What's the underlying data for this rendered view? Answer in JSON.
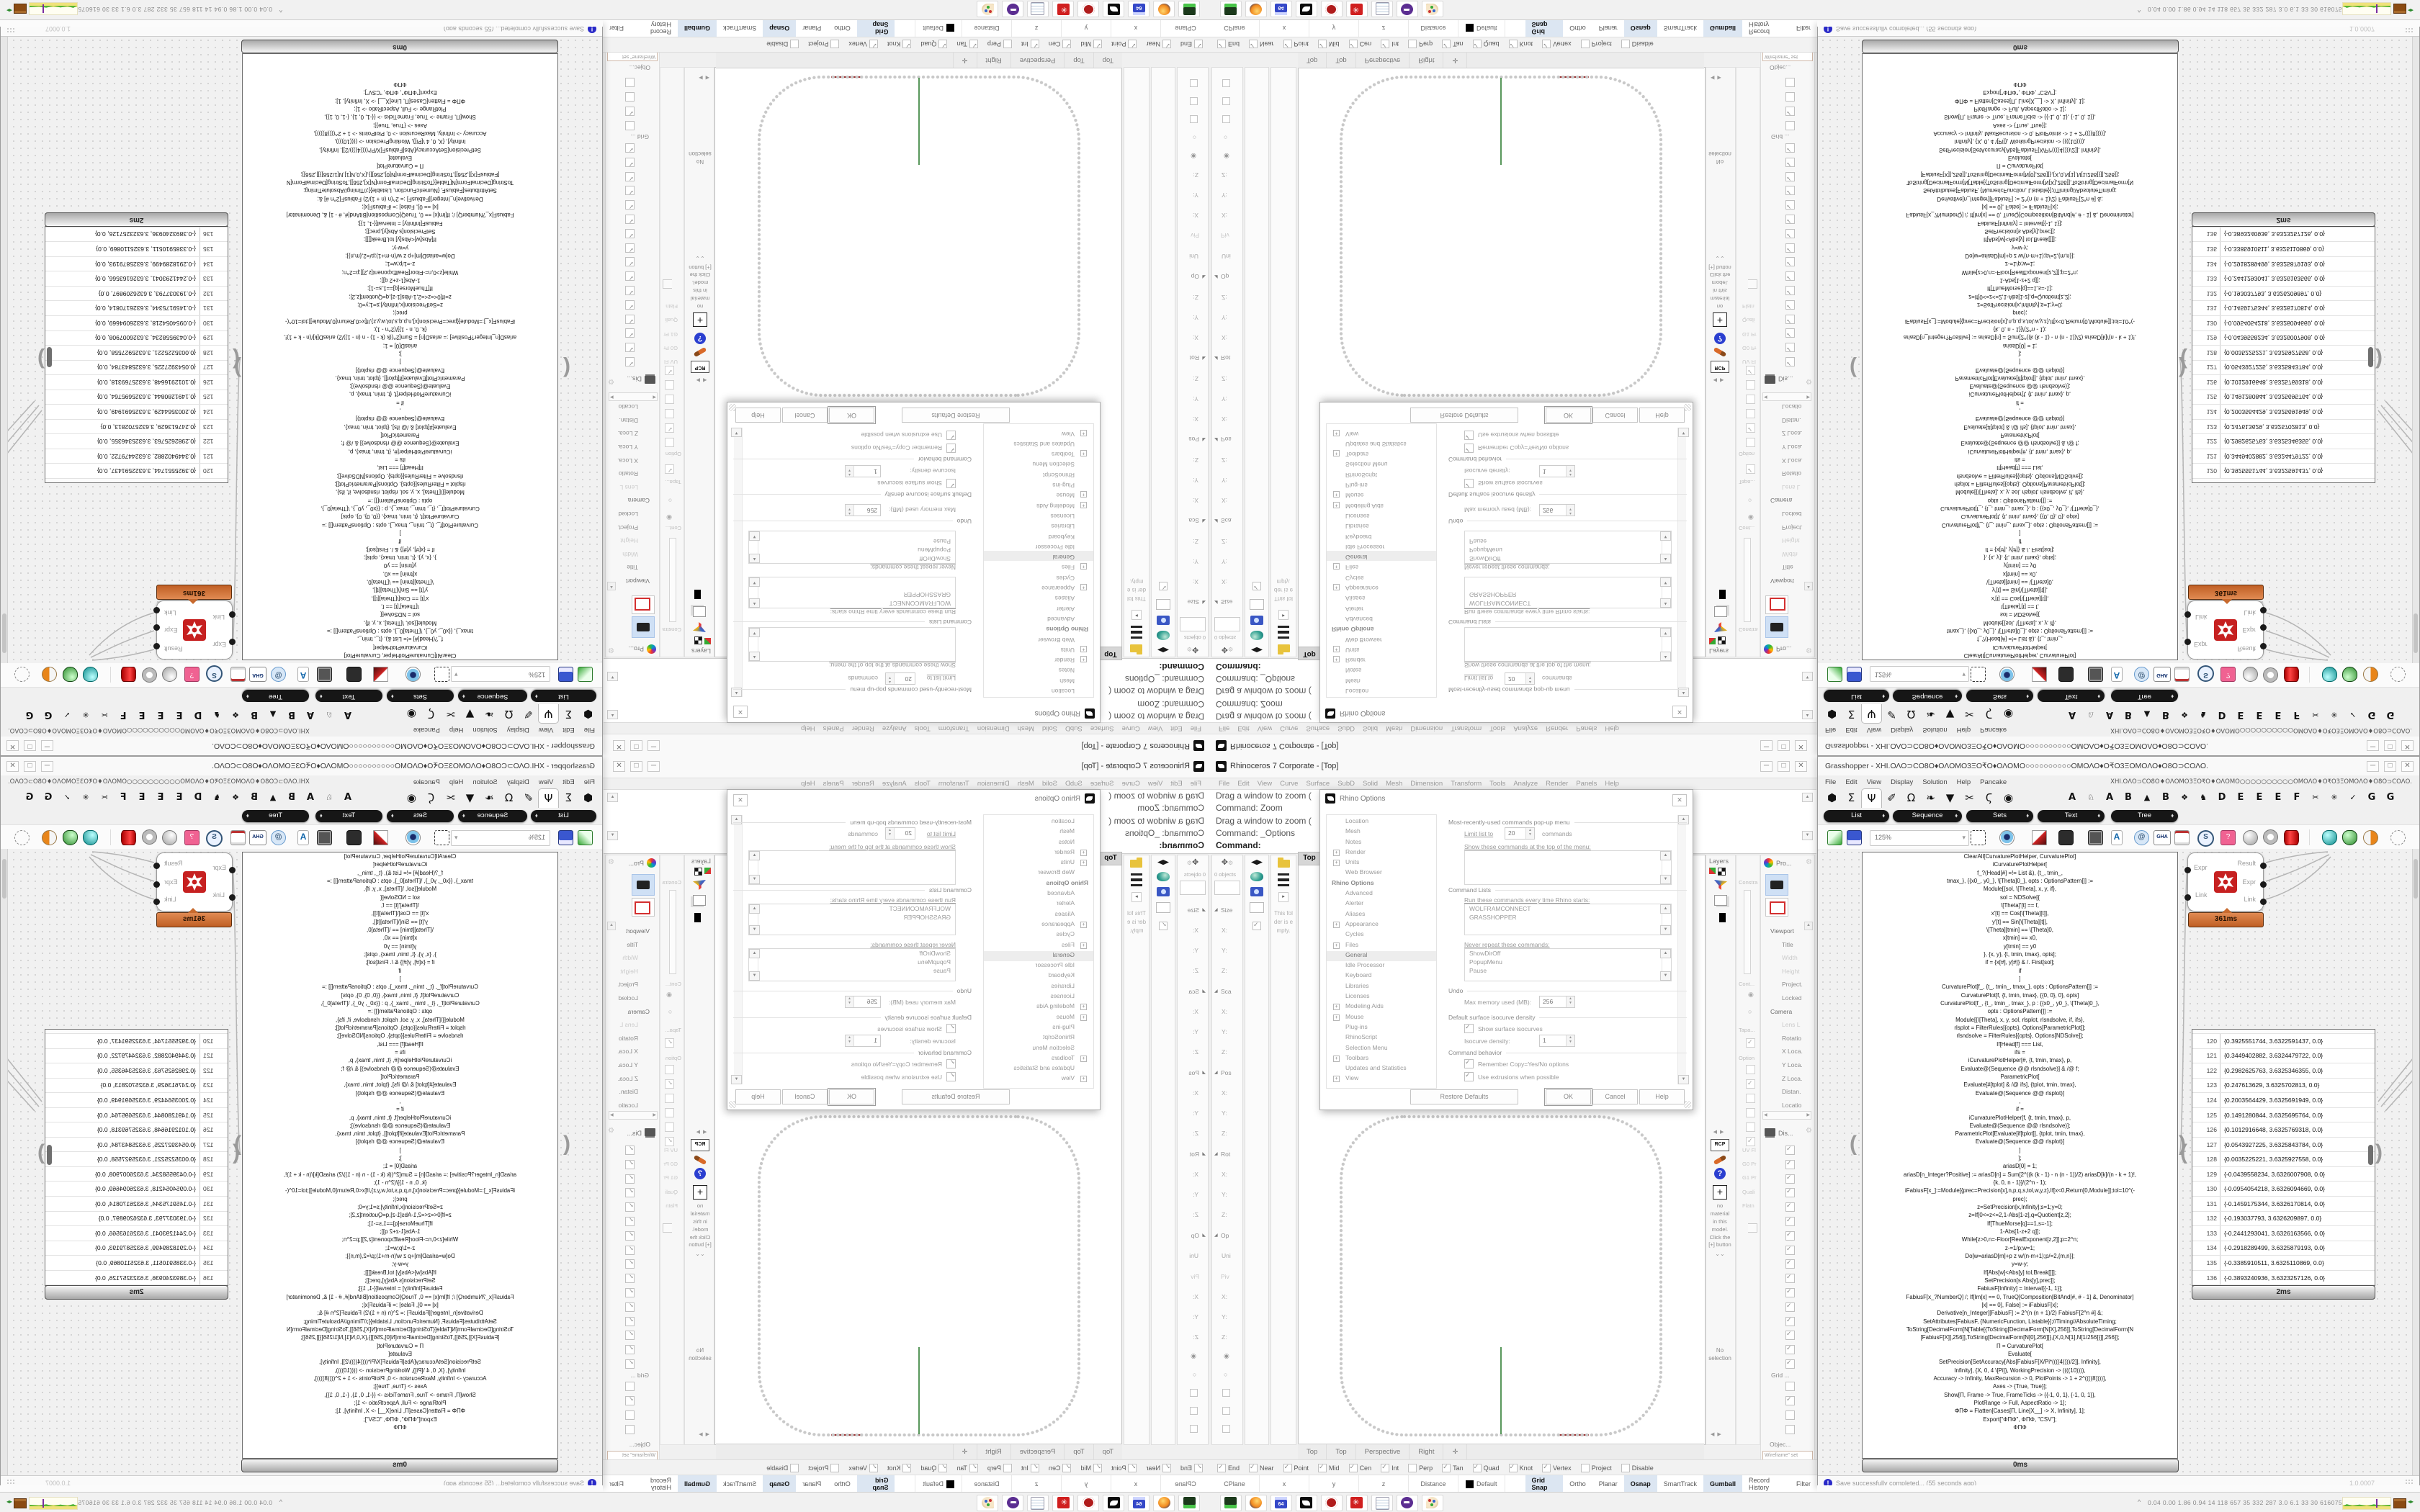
{
  "rhino": {
    "title": "Rhinoceros 7 Corporate - [Top]",
    "window_buttons": {
      "minimize": "─",
      "maximize": "□",
      "close": "✕"
    },
    "menu": [
      "File",
      "Edit",
      "View",
      "Curve",
      "Surface",
      "SubD",
      "Solid",
      "Mesh",
      "Dimension",
      "Transform",
      "Tools",
      "Analyze",
      "Render",
      "Panels",
      "Help"
    ],
    "command_history": [
      "Drag a window to zoom (",
      "Command: Zoom",
      "Drag a window to zoom (",
      "Command: _Options"
    ],
    "command_prompt": "Command:",
    "left_panel": {
      "objects_label": "0 objects",
      "empty_folder_note": "This folder is empty.",
      "boxedit": [
        {
          "c": "h",
          "l": "Size"
        },
        {
          "c": "f",
          "l": "X:"
        },
        {
          "c": "f",
          "l": "Y:"
        },
        {
          "c": "f",
          "l": "Z:"
        },
        {
          "c": "h",
          "l": "Sca"
        },
        {
          "c": "f",
          "l": "X:"
        },
        {
          "c": "f",
          "l": "Y:"
        },
        {
          "c": "f",
          "l": "Z:"
        },
        {
          "c": "h",
          "l": "Pos"
        },
        {
          "c": "f",
          "l": "X:"
        },
        {
          "c": "f",
          "l": "Y:"
        },
        {
          "c": "f",
          "l": "Z:"
        },
        {
          "c": "h",
          "l": "Rot"
        },
        {
          "c": "f",
          "l": "X:"
        },
        {
          "c": "f",
          "l": "Y:"
        },
        {
          "c": "f",
          "l": "Z:"
        },
        {
          "c": "h",
          "l": "Op"
        },
        {
          "c": "f",
          "l": "Uni"
        },
        {
          "c": "hd",
          "l": "Piv"
        },
        {
          "c": "f",
          "l": "X:"
        },
        {
          "c": "f",
          "l": "Y:"
        },
        {
          "c": "f",
          "l": "Z:"
        },
        {
          "c": "ro",
          "l": ""
        },
        {
          "c": "rf",
          "l": ""
        },
        {
          "c": "cb",
          "l": ""
        },
        {
          "c": "cb",
          "l": ""
        },
        {
          "c": "cb",
          "l": ""
        }
      ]
    },
    "viewport": {
      "label": "Top",
      "tabs": [
        "Top",
        "Top",
        "Perspective",
        "Right"
      ],
      "add_tab": "✛"
    },
    "osnap": [
      {
        "l": "End",
        "s": "on"
      },
      {
        "l": "Near",
        "s": "on"
      },
      {
        "l": "Point",
        "s": "on"
      },
      {
        "l": "Mid",
        "s": "on"
      },
      {
        "l": "Cen",
        "s": "on"
      },
      {
        "l": "Int",
        "s": "on"
      },
      {
        "l": "Perp",
        "s": "off"
      },
      {
        "l": "Tan",
        "s": "on"
      },
      {
        "l": "Quad",
        "s": "on"
      },
      {
        "l": "Knot",
        "s": "on"
      },
      {
        "l": "Vertex",
        "s": "on"
      },
      {
        "l": "Project",
        "s": "off"
      },
      {
        "l": "Disable",
        "s": "off"
      }
    ],
    "status": {
      "cells": [
        "CPlane",
        "x",
        "y",
        "z",
        "Distance"
      ],
      "default_label": "Default",
      "toggles": [
        {
          "l": "Grid Snap",
          "c": "active"
        },
        {
          "l": "Ortho",
          "c": ""
        },
        {
          "l": "Planar",
          "c": ""
        },
        {
          "l": "Osnap",
          "c": "active"
        },
        {
          "l": "SmartTrack",
          "c": ""
        },
        {
          "l": "Gumball",
          "c": "active"
        },
        {
          "l": "Record History",
          "c": ""
        },
        {
          "l": "Filter",
          "c": ""
        }
      ]
    },
    "right_dock": {
      "layers_title": "Layers",
      "constraint_label": "Constra",
      "cont_label": "Cont...",
      "taper_label": "Tapa...",
      "option_label": "Option",
      "props_title": "Pro...",
      "props": [
        {
          "l": "Viewport",
          "c": "sect"
        },
        {
          "l": "Title",
          "c": ""
        },
        {
          "l": "Width",
          "c": "dim"
        },
        {
          "l": "Height",
          "c": "dim"
        },
        {
          "l": "Project.",
          "c": ""
        },
        {
          "l": "Locked",
          "c": ""
        },
        {
          "l": "Camera",
          "c": "sect"
        },
        {
          "l": "Lens L",
          "c": "dim"
        },
        {
          "l": "Rotatio",
          "c": ""
        },
        {
          "l": "X Loca.",
          "c": ""
        },
        {
          "l": "Y Loca.",
          "c": ""
        },
        {
          "l": "Z Loca.",
          "c": ""
        },
        {
          "l": "Distan.",
          "c": ""
        },
        {
          "l": "Locatio",
          "c": ""
        }
      ],
      "display_title": "Dis...",
      "display_labels": [
        "UV Fl",
        "G0 Pr",
        "G1 Pr",
        "Quali",
        "Flatn"
      ],
      "display_checks": [
        "on",
        "on",
        "on",
        "on",
        "on",
        "on",
        "on",
        "on",
        "on",
        "on",
        "on",
        "on",
        "on",
        "on",
        "on",
        "on"
      ],
      "grid_label": "Grid ...",
      "grid_checks": [
        "off",
        "on",
        "off",
        "off"
      ],
      "object_label": "Objec...",
      "wireframe_value": "Wireframe\" set",
      "rcp_label": "RCP",
      "no_material_text": "no material in this model. Click the [+] button",
      "no_selection_text": "No selection"
    },
    "dialog": {
      "title": "Rhino Options",
      "tree": [
        {
          "l": "Location",
          "c": ""
        },
        {
          "l": "Mesh",
          "c": ""
        },
        {
          "l": "Notes",
          "c": ""
        },
        {
          "l": "Render",
          "c": "plus"
        },
        {
          "l": "Units",
          "c": "plus"
        },
        {
          "l": "Web Browser",
          "c": ""
        },
        {
          "l": "Rhino Options",
          "c": "hdr"
        },
        {
          "l": "Advanced",
          "c": ""
        },
        {
          "l": "Alerter",
          "c": ""
        },
        {
          "l": "Aliases",
          "c": ""
        },
        {
          "l": "Appearance",
          "c": "plus"
        },
        {
          "l": "Cycles",
          "c": ""
        },
        {
          "l": "Files",
          "c": "plus"
        },
        {
          "l": "General",
          "c": "sel"
        },
        {
          "l": "Idle Processor",
          "c": ""
        },
        {
          "l": "Keyboard",
          "c": ""
        },
        {
          "l": "Libraries",
          "c": ""
        },
        {
          "l": "Licenses",
          "c": ""
        },
        {
          "l": "Modeling Aids",
          "c": "plus"
        },
        {
          "l": "Mouse",
          "c": "plus"
        },
        {
          "l": "Plug-ins",
          "c": ""
        },
        {
          "l": "RhinoScript",
          "c": ""
        },
        {
          "l": "Selection Menu",
          "c": ""
        },
        {
          "l": "Toolbars",
          "c": "plus"
        },
        {
          "l": "Updates and Statistics",
          "c": ""
        },
        {
          "l": "View",
          "c": "plus"
        }
      ],
      "mru_group": "Most-recently-used commands pop-up menu",
      "limit_label": "Limit list to",
      "limit_value": "20",
      "commands_label": "commands",
      "show_top_label": "Show these commands at the top of the menu:",
      "cmd_lists_group": "Command Lists",
      "run_label": "Run these commands every time Rhino starts:",
      "run_items": [
        "WOLFRAMCONNECT",
        "GRASSHOPPER"
      ],
      "never_label": "Never repeat these commands:",
      "never_items": [
        "ShowDirOff",
        "PopupMenu",
        "Pause"
      ],
      "undo_group": "Undo",
      "undo_label": "Max memory used (MB):",
      "undo_value": "256",
      "iso_group": "Default surface isocurve density",
      "iso_cb": "Show surface isocurves",
      "iso_label": "Isocurve density:",
      "iso_value": "1",
      "behavior_group": "Command behavior",
      "behavior_cb1": "Remember Copy=Yes/No options",
      "behavior_cb2": "Use extrusions when possible",
      "buttons": [
        "Restore Defaults",
        "OK",
        "Cancel",
        "Help"
      ]
    }
  },
  "grasshopper": {
    "title": "Grasshopper - XHI.ΟΛΟ⊃CΟ8Ο♦ΟΛΟΜΟ3ΞΟ₹Ο♦ΟΛΟΜΟ○○○○○○○○○○ΟΜΟΛΟ♦Ο₹Ο3ΞΟΜΟΛΟ♦Ο8Ο⊃CΟΛΟ.",
    "window_buttons": {
      "minimize": "─",
      "maximize": "□",
      "close": "✕"
    },
    "menu": [
      "File",
      "Edit",
      "View",
      "Display",
      "Solution",
      "Help",
      "Pancake"
    ],
    "menu_glyphs": "XHI.ΟΛΟ⊃CΟ8Ο♦ΟΛΟΜΟ3ΞΟ₹Ο♦ΟΛΟΜΟ○○○○○○○○○○ΟΜΟΛΟ♦Ο₹Ο3ΞΟΜΟΛΟ♦Ο8Ο⊃CΟΛΟ.",
    "tab_icons": [
      {
        "g": "⬢",
        "c": ""
      },
      {
        "g": "Σ",
        "c": ""
      },
      {
        "g": "Ψ",
        "c": "sel"
      },
      {
        "g": "✐",
        "c": ""
      },
      {
        "g": "Ω",
        "c": ""
      },
      {
        "g": "❧",
        "c": ""
      },
      {
        "g": "▼",
        "c": ""
      },
      {
        "g": "✂",
        "c": ""
      },
      {
        "g": "Ϛ",
        "c": ""
      },
      {
        "g": "◉",
        "c": ""
      }
    ],
    "tab_letters": [
      {
        "g": "A",
        "c": ""
      },
      {
        "g": "♘",
        "c": "sm"
      },
      {
        "g": "A",
        "c": ""
      },
      {
        "g": "B",
        "c": ""
      },
      {
        "g": "▲",
        "c": "sm"
      },
      {
        "g": "B",
        "c": ""
      },
      {
        "g": "❖",
        "c": "sm"
      },
      {
        "g": "♞",
        "c": "sm"
      },
      {
        "g": "D",
        "c": ""
      },
      {
        "g": "E",
        "c": ""
      },
      {
        "g": "E",
        "c": ""
      },
      {
        "g": "E",
        "c": ""
      },
      {
        "g": "F",
        "c": ""
      },
      {
        "g": "✂",
        "c": "sm"
      },
      {
        "g": "✳",
        "c": "sm"
      },
      {
        "g": "✓",
        "c": "sm"
      },
      {
        "g": "G",
        "c": ""
      },
      {
        "g": "G",
        "c": ""
      }
    ],
    "pills": [
      "List",
      "Sequence",
      "Sets",
      "Text",
      "Tree"
    ],
    "zoom_value": "125%",
    "component": {
      "time": "361ms",
      "inputs": [
        "Expr",
        "Link"
      ],
      "outputs": [
        "Result",
        "Expr",
        "Link"
      ]
    },
    "code_panel": {
      "time": "0ms",
      "lines": [
        "ClearAll[CurvaturePlotHelper, CurvaturePlot]",
        "iCurvaturePlotHelper[",
        "f_?(Head[#] =!= List &), {t_, tmin_,",
        "tmax_}, {{x0_, y0_}, \\[Theta]0_}, opts : OptionsPattern[]] :=",
        "Module[{sol, \\[Theta], x, y, if},",
        "sol = NDSolve[{",
        "\\[Theta]'[t] == f,",
        "x'[t] == Cos[\\[Theta][t]],",
        "y'[t] == Sin[\\[Theta][t]],",
        "\\[Theta][tmin] == \\[Theta]0,",
        "x[tmin] == x0,",
        "y[tmin] == y0",
        "}, {x, y}, {t, tmin, tmax}, opts];",
        "if = {x[#], y[#]} & /. First[sol];",
        "if",
        "]",
        "CurvaturePlot[f_, {t_, tmin_, tmax_}, opts : OptionsPattern[]] :=",
        "CurvaturePlot[f, {t, tmin, tmax}, {{0, 0}, 0}, opts]",
        "CurvaturePlot[f_, {t_, tmin_, tmax_}, p : {{x0_, y0_}, \\[Theta]0_},",
        "opts : OptionsPattern[]] :=",
        "Module[{\\[Theta], x, y, sol, rlsplot, rlsndsolve, if, ifs},",
        "rlsplot = FilterRules[{opts}, Options[ParametricPlot]];",
        "rlsndsolve = FilterRules[{opts}, Options[NDSolve]];",
        "If[Head[f] === List,",
        "ifs =",
        "iCurvaturePlotHelper[#, {t, tmin, tmax}, p,",
        "Evaluate@(Sequence @@ rlsndsolve)] & /@ f;",
        "ParametricPlot[",
        "Evaluate[#[tplot] & /@ ifs], {tplot, tmin, tmax},",
        "Evaluate@(Sequence @@ rlsplot)]",
        ",",
        "if =",
        "iCurvaturePlotHelper[f, {t, tmin, tmax}, p,",
        "Evaluate@(Sequence @@ rlsndsolve)];",
        "ParametricPlot[Evaluate[if[tplot]], {tplot, tmin, tmax},",
        "Evaluate@(Sequence @@ rlsplot)]",
        "]",
        "];",
        "",
        "ariasD[0] = 1;",
        "ariasD[n_Integer?Positive] := ariasD[n] = Sum[2^((k (k - 1) - n (n - 1))/2) ariasD[k]/(n - k + 1)!,",
        "{k, 0, n - 1}]/(2^n - 1);",
        "iFabiusF[x_]:=Module[{prec=Precision[x],n,p,q,s,tol,w,y,z},If[x<0,Return[0,Module]];tol=10^(-",
        "prec);",
        "z=SetPrecision[x,Infinity];s=1;y=0;",
        "z=If[0<=z<=2,1-Abs[1-z],q=Quotient[z,2];",
        "If[ThueMorse[q]==1,s=-1];",
        "1-Abs[1-z+2 q]];",
        "While[z>0,n=-Floor[RealExponent[z,2]];p=2^n;",
        "z-=1/p;w=1;",
        "Do[w=ariasD[m]+p z w/(n-m+1);p/=2,{m,n}];",
        "y=w-y;",
        "If[Abs[w]<Abs[y] tol,Break[]]];",
        "SetPrecision[s Abs[y],prec]];",
        "FabiusF[Infinity] = Interval[{-1, 1}];",
        "FabiusF[x_?NumberQ] /; If[Im[x] == 0, TrueQ[Composition[BitAnd[#, # - 1] &, Denominator]",
        "[x] == 0], False] := iFabiusF[x];",
        "Derivative[n_Integer][FabiusF] := 2^(n (n + 1)/2) FabiusF[2^n #] &;",
        "SetAttributes[FabiusF, {NumericFunction, Listable}];//Timing//AbsoluteTiming;",
        "",
        "ToString[DecimalForm[N[Table[{ToString[DecimalForm[N[X],256]],ToString[DecimalForm[N",
        "[FabiusF[X]],256]],ToString[DecimalForm[N[0],256]]},{X,0,N[1],N[1/256]}]],256]];",
        "",
        "Π = CurvaturePlot[",
        "Evaluate[",
        "SetPrecision[SetAccuracy[Abs[FabiusF[X/Pi*((((4))))/2]], Infinity],",
        "Infinity], {X, 0, 4 \\[Pi]}, WorkingPrecision -> ((((10)))),",
        "Accuracy -> Infinity, MaxRecursion -> 0, PlotPoints -> 1 + 2^((((8))))],",
        "Axes -> {True, True}];",
        "Show[Π, Frame -> True, FrameTicks -> {{-1, 0, 1}, {-1, 0, 1}},",
        "PlotRange -> Full, AspectRatio -> 1];",
        "ΦΠΦ = Flatten[Cases[Π, Line[X__] -> X, Infinity], 1];",
        "Export[\"ΦΠΦ\", ΦΠΦ, \"CSV\"];",
        "ΦΠΦ"
      ]
    },
    "data_panel": {
      "time": "2ms",
      "rows": [
        {
          "n": "120",
          "v": "{0.3925551744, 3.6322591437, 0.0}"
        },
        {
          "n": "121",
          "v": "{0.3449402882, 3.6324479722, 0.0}"
        },
        {
          "n": "122",
          "v": "{0.2982625763, 3.6325346355, 0.0}"
        },
        {
          "n": "123",
          "v": "{0.247613629, 3.6325702813, 0.0}"
        },
        {
          "n": "124",
          "v": "{0.2003564429, 3.6325691949, 0.0}"
        },
        {
          "n": "125",
          "v": "{0.1491280844, 3.6325695764, 0.0}"
        },
        {
          "n": "126",
          "v": "{0.1012916648, 3.6325769318, 0.0}"
        },
        {
          "n": "127",
          "v": "{0.0543927225, 3.6325843784, 0.0}"
        },
        {
          "n": "128",
          "v": "{0.0035225221, 3.6325927558, 0.0}"
        },
        {
          "n": "129",
          "v": "{-0.0439558234, 3.6326007908, 0.0}"
        },
        {
          "n": "130",
          "v": "{-0.0954054218, 3.6326094669, 0.0}"
        },
        {
          "n": "131",
          "v": "{-0.1459175344, 3.6326170814, 0.0}"
        },
        {
          "n": "132",
          "v": "{-0.193037793, 3.6326209897, 0.0}"
        },
        {
          "n": "133",
          "v": "{-0.2441293041, 3.6326163566, 0.0}"
        },
        {
          "n": "134",
          "v": "{-0.2918289499, 3.6325879193, 0.0}"
        },
        {
          "n": "135",
          "v": "{-0.3385910511, 3.6325110869, 0.0}"
        },
        {
          "n": "136",
          "v": "{-0.3893240936, 3.6323257126, 0.0}"
        },
        {
          "n": "137",
          "v": "{-0.4366640544, 3.6249882257, 0.0}"
        }
      ]
    },
    "status_text": "Save successfully completed... (55 seconds ago)",
    "version": "1.0.0007"
  },
  "taskbar": {
    "chevron": "^",
    "floppy_label": "64",
    "numbers": "0.04 0.00 1.86 0.94    14    118   657    35    332   287   3.0    6.1    33    30   61607592",
    "icon_names": [
      "zip-drive",
      "firefox",
      "floppy-64",
      "rhino",
      "mathematica",
      "wolfram-gear",
      "notepad",
      "bot",
      "palette"
    ]
  },
  "colors": {
    "capsule_orange": "#d2743c",
    "axis_green": "#2f7e33",
    "axis_red": "#993333",
    "toggle_active_bg": "#dce6f2",
    "curve_dot": "#c9c9c9"
  }
}
